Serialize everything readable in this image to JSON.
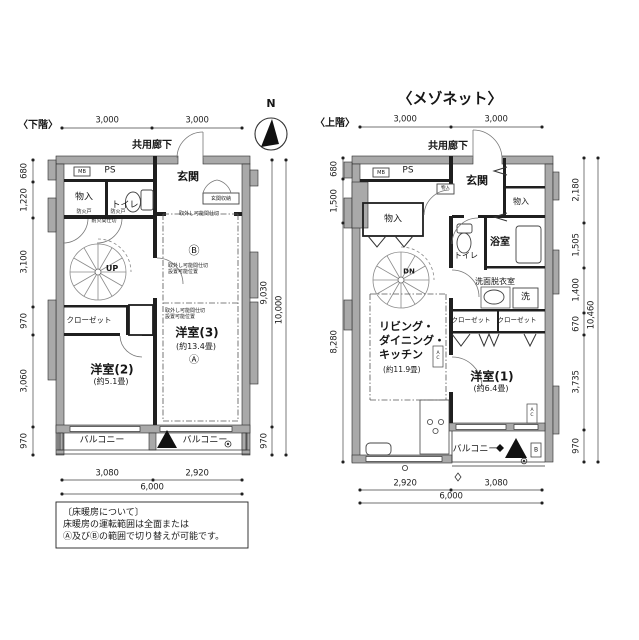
{
  "page": {
    "title": "〈メゾネット〉",
    "compass": "N"
  },
  "note": {
    "l1": "〔床暖房について〕",
    "l2": "床暖房の運転範囲は全面または",
    "l3": "Ⓐ及びⒷの範囲で切り替えが可能です。"
  },
  "lower": {
    "heading": "〈下階〉",
    "corridor": "共用廊下",
    "mb": "MB",
    "ps": "PS",
    "genkan": "玄関",
    "genkan_shuno": "玄関収納",
    "monoiri": "物入",
    "toilet": "トイレ",
    "fire1": "防火戸",
    "fire2": "防火戸",
    "fire3": "耐火間仕切",
    "rm_line": "取外し可能間仕切",
    "rm_note1": "取外し可能間仕切\n設置可能位置",
    "rm_note2": "取外し可能間仕切\n設置可能位置",
    "mark_b": "Ⓑ",
    "mark_a": "Ⓐ",
    "up": "UP",
    "closet": "クローゼット",
    "room2": "洋室(2)",
    "room2_size": "(約5.1畳)",
    "room3": "洋室(3)",
    "room3_size": "(約13.4畳)",
    "balcony_l": "バルコニー",
    "balcony_r": "バルコニー",
    "dims": {
      "top": [
        "3,000",
        "3,000"
      ],
      "left": [
        "680",
        "1,220",
        "3,100",
        "970",
        "3,060",
        "970"
      ],
      "right": [
        "9,030",
        "970",
        "10,000"
      ],
      "bottom": [
        "3,080",
        "2,920",
        "6,000"
      ]
    }
  },
  "upper": {
    "heading": "〈上階〉",
    "corridor": "共用廊下",
    "mb": "MB",
    "ps": "PS",
    "genkan": "玄関",
    "mono_s": "物入",
    "mono_r": "物入",
    "mono_l": "物入",
    "toilet": "トイレ",
    "bath": "浴室",
    "wash_room": "洗面脱衣室",
    "washer": "洗",
    "dn": "DN",
    "ldk": "リビング・\nダイニング・\nキッチン",
    "ldk_size": "(約11.9畳)",
    "closet1": "クローゼット",
    "closet2": "クローゼット",
    "room1": "洋室(1)",
    "room1_size": "(約6.4畳)",
    "balcony": "バルコニー",
    "ac1": "A\nC",
    "ac2": "A\nC",
    "b_box": "B",
    "dims": {
      "top": [
        "3,000",
        "3,000"
      ],
      "left": [
        "680",
        "1,500",
        "8,280"
      ],
      "right": [
        "2,180",
        "1,505",
        "1,400",
        "670",
        "3,735",
        "970",
        "10,460"
      ],
      "bottom": [
        "2,920",
        "3,080",
        "6,000"
      ]
    }
  }
}
